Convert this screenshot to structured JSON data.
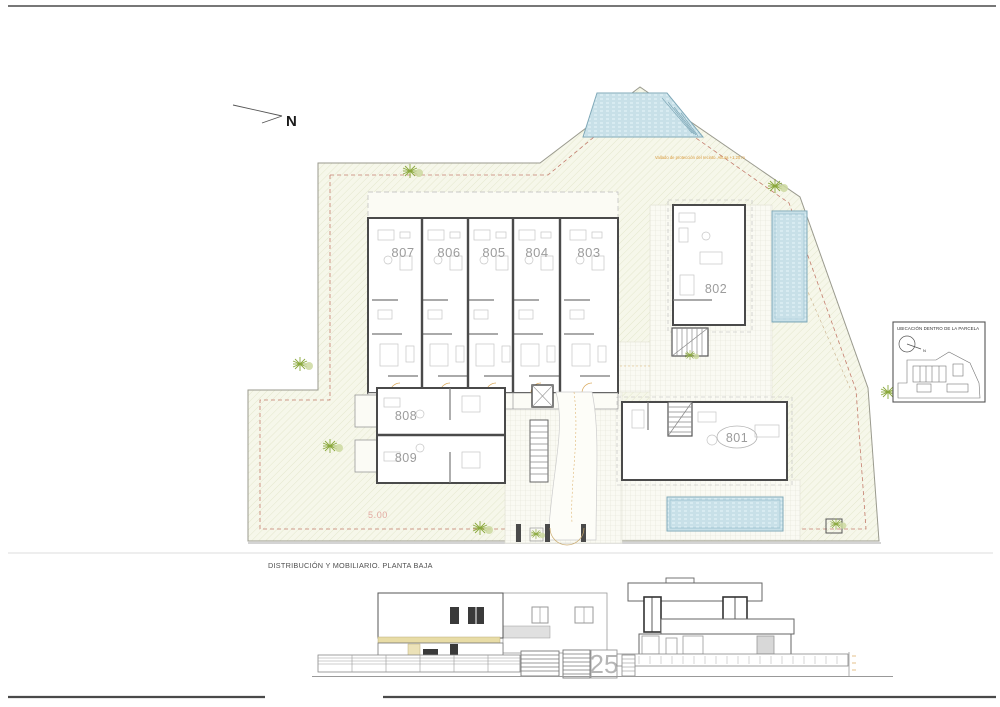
{
  "page": {
    "north_label": "N",
    "caption": "DISTRIBUCIÓN Y MOBILIARIO. PLANTA BAJA",
    "street_number": "25"
  },
  "site": {
    "fence_note": "Vallado de protección del recinto. Altura +1,20 m",
    "dimension_label": "5.00",
    "units": [
      {
        "id": "807"
      },
      {
        "id": "806"
      },
      {
        "id": "805"
      },
      {
        "id": "804"
      },
      {
        "id": "803"
      },
      {
        "id": "802"
      },
      {
        "id": "801"
      },
      {
        "id": "808"
      },
      {
        "id": "809"
      }
    ]
  },
  "legend": {
    "title": "UBICACIÓN DENTRO DE LA PARCELA",
    "north_label": "N"
  },
  "colors": {
    "water": "#d8ebf1",
    "water_line": "#aed0da",
    "parcel_fill": "#f6f7ea",
    "hatch_line": "#e4e7cd",
    "wall": "#4a4a4a",
    "furniture": "#c6c6c6",
    "setback_dash": "#c47d6d",
    "accent_orange": "#d99a3c",
    "dimension_pink": "#e2a9a0",
    "tree_green": "#8aa83c",
    "facade_beige": "#e8dca6",
    "street_number_gray": "#b5b5b5"
  }
}
